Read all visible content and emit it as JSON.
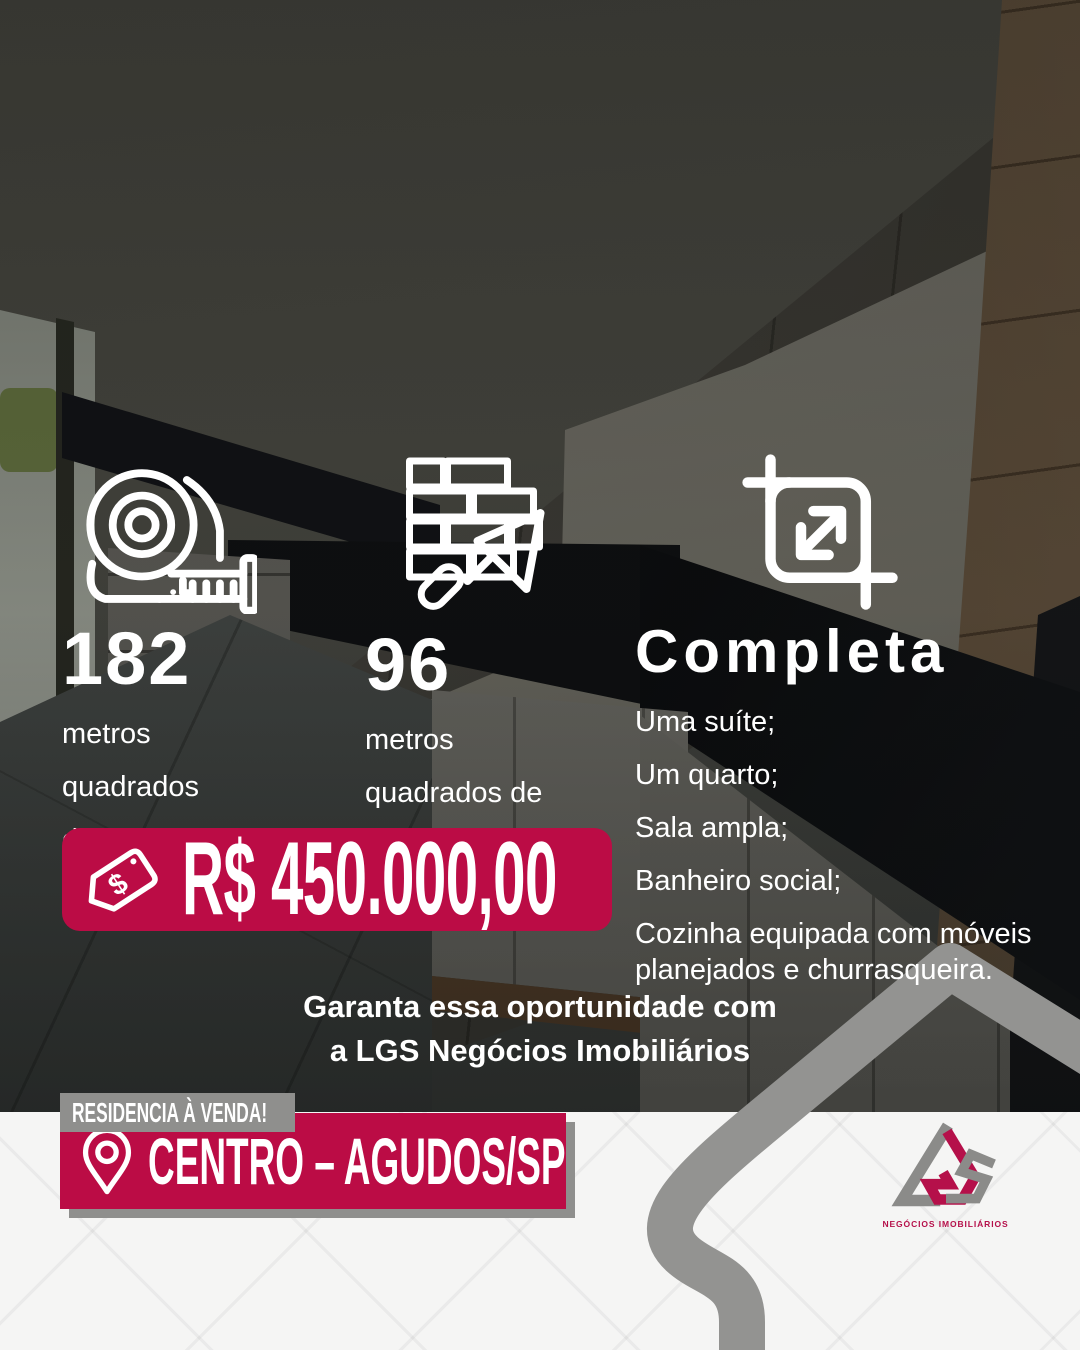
{
  "colors": {
    "accent_crimson": "#bb0c45",
    "ribbon_gray": "#8f8f8d",
    "house_outline_gray": "#939391",
    "footer_background": "#f5f5f4",
    "text_white": "#ffffff"
  },
  "features": [
    {
      "icon": "tape-measure-icon",
      "value": "182",
      "label": "metros\nquadrados\nde terreno"
    },
    {
      "icon": "bricks-trowel-icon",
      "value": "96",
      "label": "metros\nquadrados de\nárea construída"
    },
    {
      "icon": "expand-icon",
      "value": "Completa",
      "items": [
        "Uma suíte;",
        "Um quarto;",
        "Sala ampla;",
        "Banheiro social;",
        "Cozinha equipada com móveis planejados e churrasqueira."
      ]
    }
  ],
  "price": {
    "icon": "price-tag-icon",
    "label": "R$ 450.000,00"
  },
  "cta": {
    "line1": "Garanta essa oportunidade com",
    "line2": "a LGS Negócios Imobiliários"
  },
  "ribbon": {
    "label": "RESIDENCIA À VENDA!"
  },
  "location": {
    "icon": "location-pin-icon",
    "label": "CENTRO – AGUDOS/SP"
  },
  "logo": {
    "monogram": "LGS",
    "caption": "NEGÓCIOS IMOBILIÁRIOS"
  }
}
